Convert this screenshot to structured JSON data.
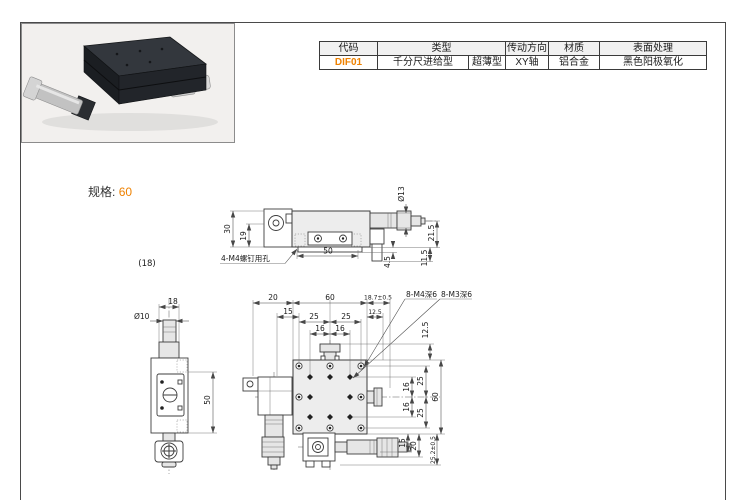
{
  "colors": {
    "accent": "#ee8100",
    "drawing_line": "#3d3d3d",
    "page_border": "#4a4a4a"
  },
  "spec": {
    "label": "规格:",
    "value": "60"
  },
  "table": {
    "headers": {
      "code": "代码",
      "type": "类型",
      "drive": "传动方向",
      "material": "材质",
      "surface": "表面处理"
    },
    "row": {
      "code": "DIF01",
      "type_feed": "千分尺进给型",
      "type_profile": "超薄型",
      "drive": "XY轴",
      "material": "铝合金",
      "surface": "黑色阳极氧化"
    }
  },
  "drawings": {
    "note_height": "(18)",
    "side_view": {
      "d30": "30",
      "d19": "19",
      "dia13": "Ø13",
      "d21_5": "21.5",
      "d4_5": "4.5",
      "d11_5": "11.5",
      "d50": "50",
      "screw_label": "4-M4螺钉用孔"
    },
    "front_view": {
      "d18": "18",
      "dia10": "Ø10",
      "d50": "50"
    },
    "top_view": {
      "d20": "20",
      "d60": "60",
      "d18_7": "18.7±0.5",
      "d15": "15",
      "d12_5": "12.5",
      "d25": "25",
      "d16": "16",
      "d12_5r": "12.5",
      "d25r": "25",
      "d16r": "16",
      "d60r": "60",
      "d15b": "15",
      "d20b": "20",
      "d25_2": "25.2±0.5",
      "m4": "8-M4深6",
      "m3": "8-M3深6"
    }
  }
}
